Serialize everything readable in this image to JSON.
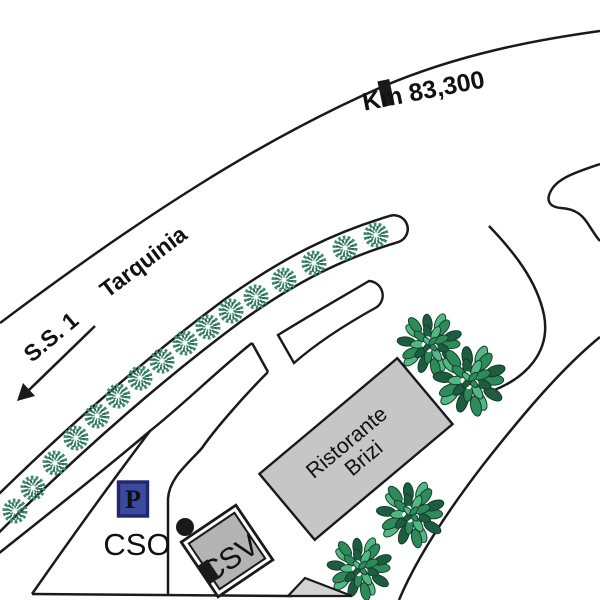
{
  "labels": {
    "road_name": "S.S. 1",
    "destination": "Tarquinia",
    "km_marker": "Km 83,300",
    "cso": "CSO",
    "csv": "CSV",
    "restaurant_line1": "Ristorante",
    "restaurant_line2": "Brizi",
    "parking": "P"
  },
  "colors": {
    "road_line": "#1a1a1a",
    "restaurant_fill": "#c6c6c6",
    "csv_fill": "#b3b3b3",
    "triangle_fill": "#d2d2d2",
    "parking_fill": "#3b4a9e",
    "parking_border": "#23256e",
    "parking_letter": "#ffffff",
    "median_tree_green": "#3f8a6d",
    "median_tree_dark": "#2c6e54",
    "bush_dark": "#1e5c3f",
    "bush_mid": "#2f8a5a",
    "bush_light": "#55b583",
    "bush_outline": "#0f3d28"
  },
  "marks": {
    "median_trees": [
      [
        15,
        511
      ],
      [
        33,
        488
      ],
      [
        55,
        463
      ],
      [
        76,
        438
      ],
      [
        97,
        416
      ],
      [
        118,
        396
      ],
      [
        140,
        378
      ],
      [
        162,
        361
      ],
      [
        185,
        343
      ],
      [
        208,
        327
      ],
      [
        231,
        311
      ],
      [
        256,
        297
      ],
      [
        284,
        280
      ],
      [
        314,
        263
      ],
      [
        345,
        248
      ],
      [
        376,
        235
      ]
    ],
    "bushes": [
      [
        430,
        344,
        1.0
      ],
      [
        470,
        380,
        1.12
      ],
      [
        411,
        514,
        1.05
      ],
      [
        360,
        568,
        1.0
      ]
    ]
  }
}
